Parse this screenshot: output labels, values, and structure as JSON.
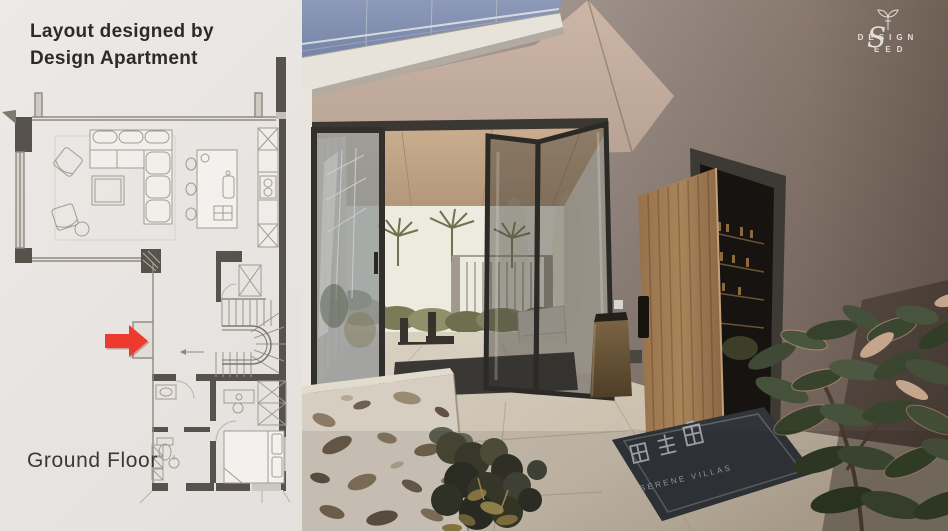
{
  "panel": {
    "credit": "Layout designed by Design Apartment",
    "floor_label": "Ground Floor"
  },
  "watermark": {
    "line1": "DESIGN",
    "line2": "EED",
    "big_letter": "S"
  },
  "doormat": {
    "text": "SERENE VILLAS"
  },
  "icons": {
    "sprout": "sprout-icon",
    "red_arrow": "red-arrow-icon"
  },
  "palette": {
    "accent_red": "#ee3a2e",
    "panel_background": "#e9e6e3",
    "plan_wall": "#57524b",
    "photo_wall": "#978a81",
    "ceiling": "#c3ac9c",
    "door_wood": "#a07c55",
    "floor_tile": "#d0c4b3",
    "doormat": "#32363a",
    "glass_balustrade": "#8494b8",
    "watermark_text": "#ece9e4"
  }
}
